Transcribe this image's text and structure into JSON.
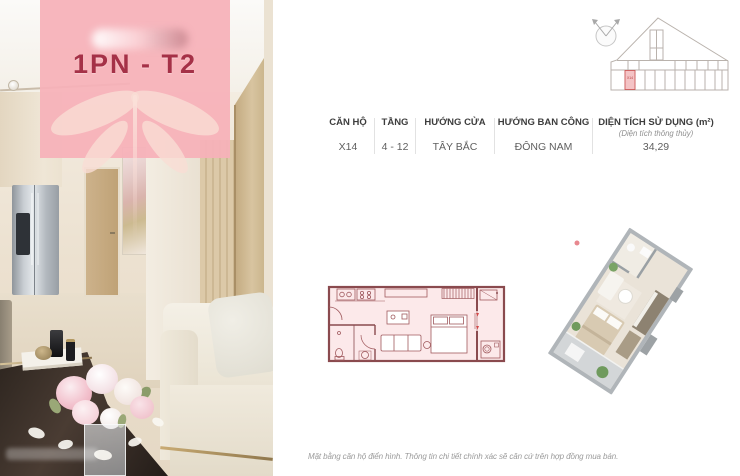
{
  "badge": {
    "unit_label": "1PN - T2"
  },
  "key_plan": {
    "unit_label": "X14"
  },
  "spec_table": {
    "columns": [
      {
        "label": "CĂN HỘ",
        "value": "X14"
      },
      {
        "label": "TẦNG",
        "value": "4 - 12"
      },
      {
        "label": "HƯỚNG CỬA",
        "value": "TÂY BẮC"
      },
      {
        "label": "HƯỚNG BAN CÔNG",
        "value": "ĐÔNG NAM"
      },
      {
        "label": "DIỆN TÍCH SỬ DỤNG (m²)",
        "sublabel": "(Diện tích thông thủy)",
        "value": "34,29"
      }
    ]
  },
  "footer": {
    "disclaimer": "Mặt bằng căn hộ điển hình. Thông tin chi tiết chính xác sẽ căn cứ trên hợp đồng mua bán."
  },
  "colors": {
    "badge_pink": "#f5b1b9",
    "accent_red": "#a53147",
    "plan_line": "#8a4a4e",
    "plan_fill": "#fce9ea",
    "highlight_red": "#cc4f4f"
  }
}
